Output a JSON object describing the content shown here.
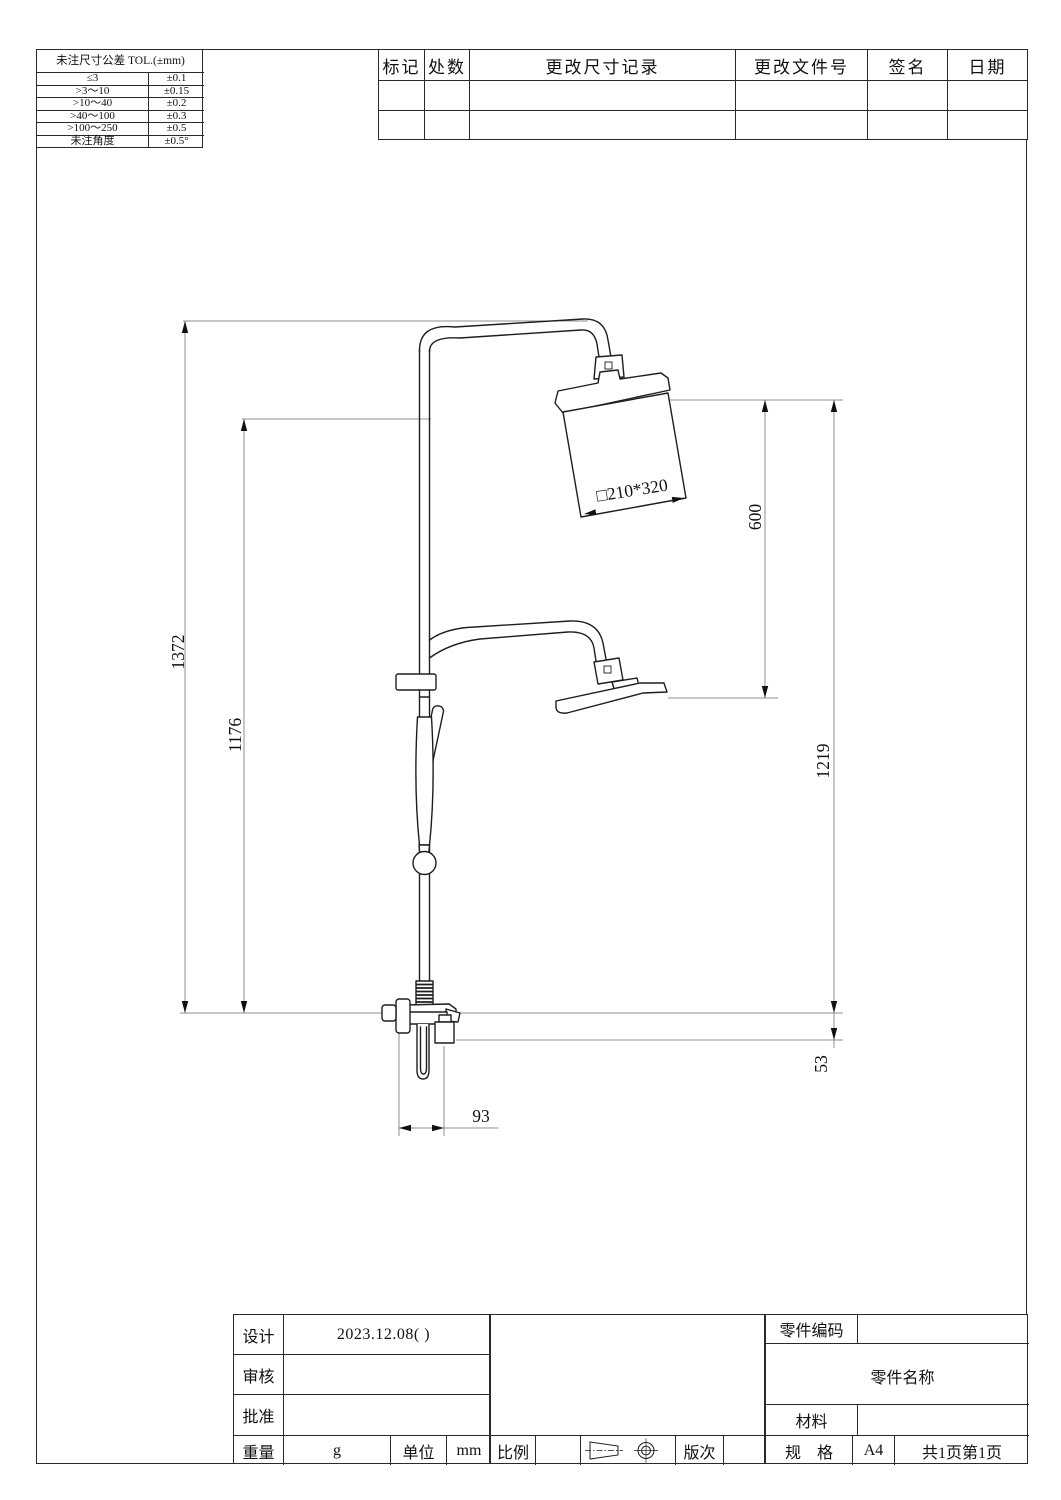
{
  "page": {
    "background": "#ffffff",
    "line_color": "#1e1e1e",
    "ext_line_color": "#8f8f8f"
  },
  "tolerance_table": {
    "title": "未注尺寸公差 TOL.(±mm)",
    "rows": [
      [
        "≤3",
        "±0.1"
      ],
      [
        ">3～10",
        "±0.15"
      ],
      [
        ">10～40",
        "±0.2"
      ],
      [
        ">40～100",
        "±0.3"
      ],
      [
        ">100～250",
        "±0.5"
      ],
      [
        "未注角度",
        "±0.5°"
      ]
    ]
  },
  "revision_table": {
    "headers": [
      "标记",
      "处数",
      "更改尺寸记录",
      "更改文件号",
      "签名",
      "日期"
    ]
  },
  "drawing": {
    "dim_total_height": "1372",
    "dim_upper_height": "1176",
    "dim_head_drop": "600",
    "dim_outlet_height": "1219",
    "dim_spout_offset": "53",
    "dim_wall_offset": "93",
    "dim_head_size": "□210*320"
  },
  "title_block": {
    "design_label": "设计",
    "design_value": "2023.12.08( )",
    "review_label": "审核",
    "review_value": "",
    "approve_label": "批准",
    "approve_value": "",
    "weight_label": "重量",
    "weight_value": "g",
    "unit_label": "单位",
    "unit_value": "mm",
    "scale_label": "比例",
    "scale_value": "",
    "revision_label": "版次",
    "revision_value": "",
    "part_code_label": "零件编码",
    "part_code_value": "",
    "part_name_label": "零件名称",
    "part_name_value": "",
    "material_label": "材料",
    "material_value": "",
    "spec_label": "规　格",
    "spec_value": "A4",
    "pages_total": "共1页",
    "page_number": "第1页"
  }
}
